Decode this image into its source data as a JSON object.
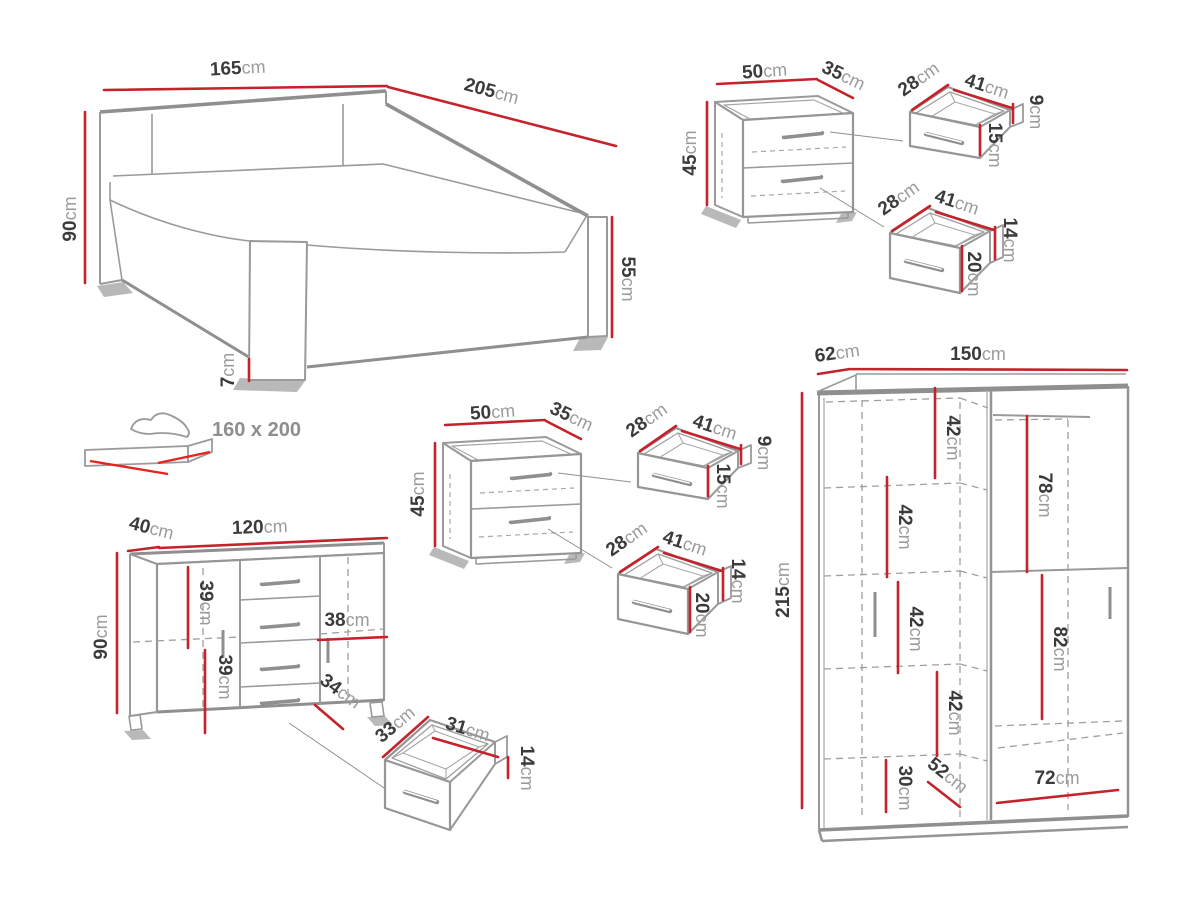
{
  "unit": "cm",
  "bed": {
    "width": "165",
    "length": "205",
    "height": "90",
    "side_height": "55",
    "leg_height": "7",
    "mattress_size": "160 x 200"
  },
  "nightstand_top": {
    "width": "50",
    "depth": "35",
    "height": "45",
    "drawer_small": {
      "depth": "28",
      "width": "41",
      "back_height": "9",
      "front_height": "15"
    },
    "drawer_large": {
      "depth": "28",
      "width": "41",
      "back_height": "14",
      "front_height": "20"
    }
  },
  "nightstand_middle": {
    "width": "50",
    "depth": "35",
    "height": "45",
    "drawer_small": {
      "depth": "28",
      "width": "41",
      "back_height": "9",
      "front_height": "15"
    },
    "drawer_large": {
      "depth": "28",
      "width": "41",
      "back_height": "14",
      "front_height": "20"
    }
  },
  "dresser": {
    "depth": "40",
    "width": "120",
    "height": "90",
    "upper_section": "39",
    "lower_section": "39",
    "right_shelf_width": "38",
    "bottom_front": "34",
    "drawer": {
      "depth": "33",
      "width": "31",
      "height": "14"
    }
  },
  "wardrobe": {
    "depth": "62",
    "width": "150",
    "height": "215",
    "shelf_1": "42",
    "shelf_2": "42",
    "shelf_3": "42",
    "shelf_4": "42",
    "hanging_top": "78",
    "hanging_bottom": "82",
    "base_height": "30",
    "diagonal": "52",
    "inner_width": "72"
  }
}
